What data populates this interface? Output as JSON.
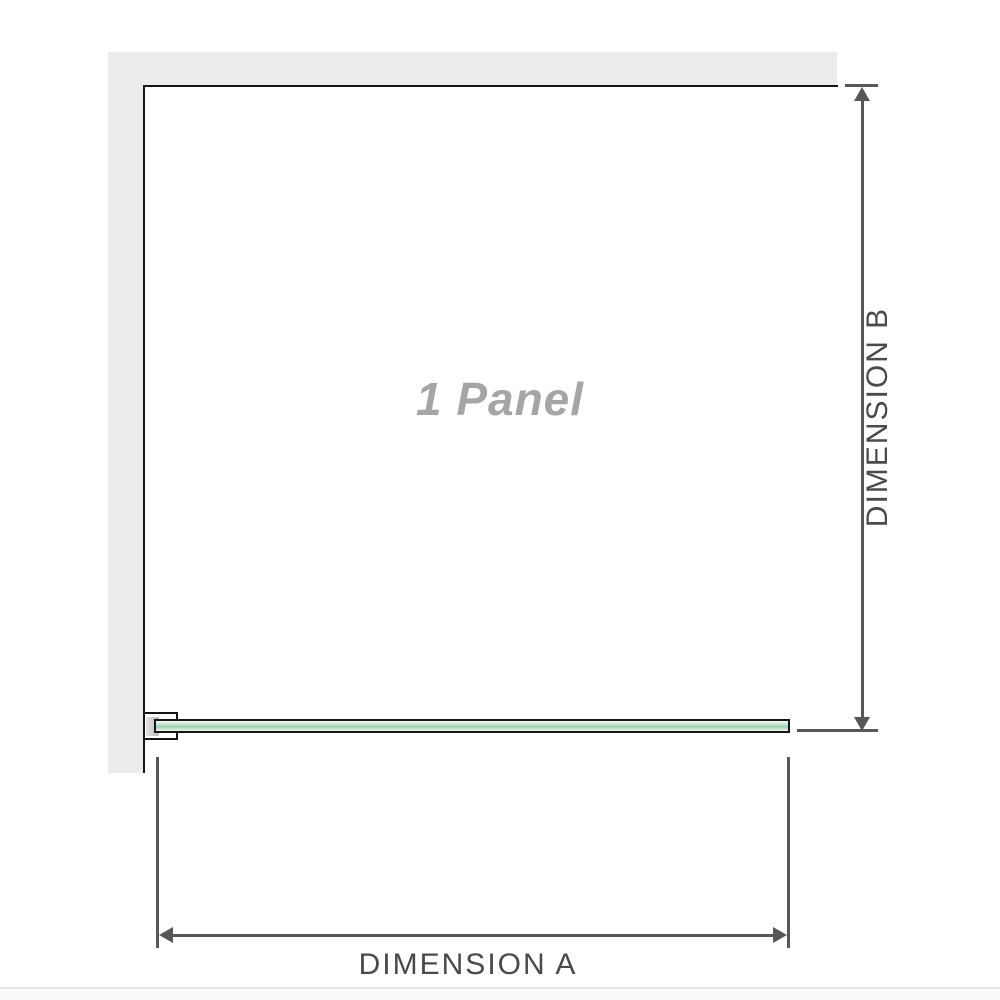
{
  "diagram": {
    "panel_label": "1 Panel",
    "dimension_a_label": "DIMENSION A",
    "dimension_b_label": "DIMENSION B"
  },
  "colors": {
    "wall_gray": "#ececeb",
    "outline_black": "#161616",
    "glass_mid": "#98cfae",
    "glass_light": "#edf7f0",
    "dimension_line_gray": "#575757",
    "dimension_text_gray": "#4a4a4a",
    "panel_label_gray": "#a5a5a5",
    "baseline_light": "#e4e3df",
    "footer_offwhite": "#fafaf8"
  }
}
